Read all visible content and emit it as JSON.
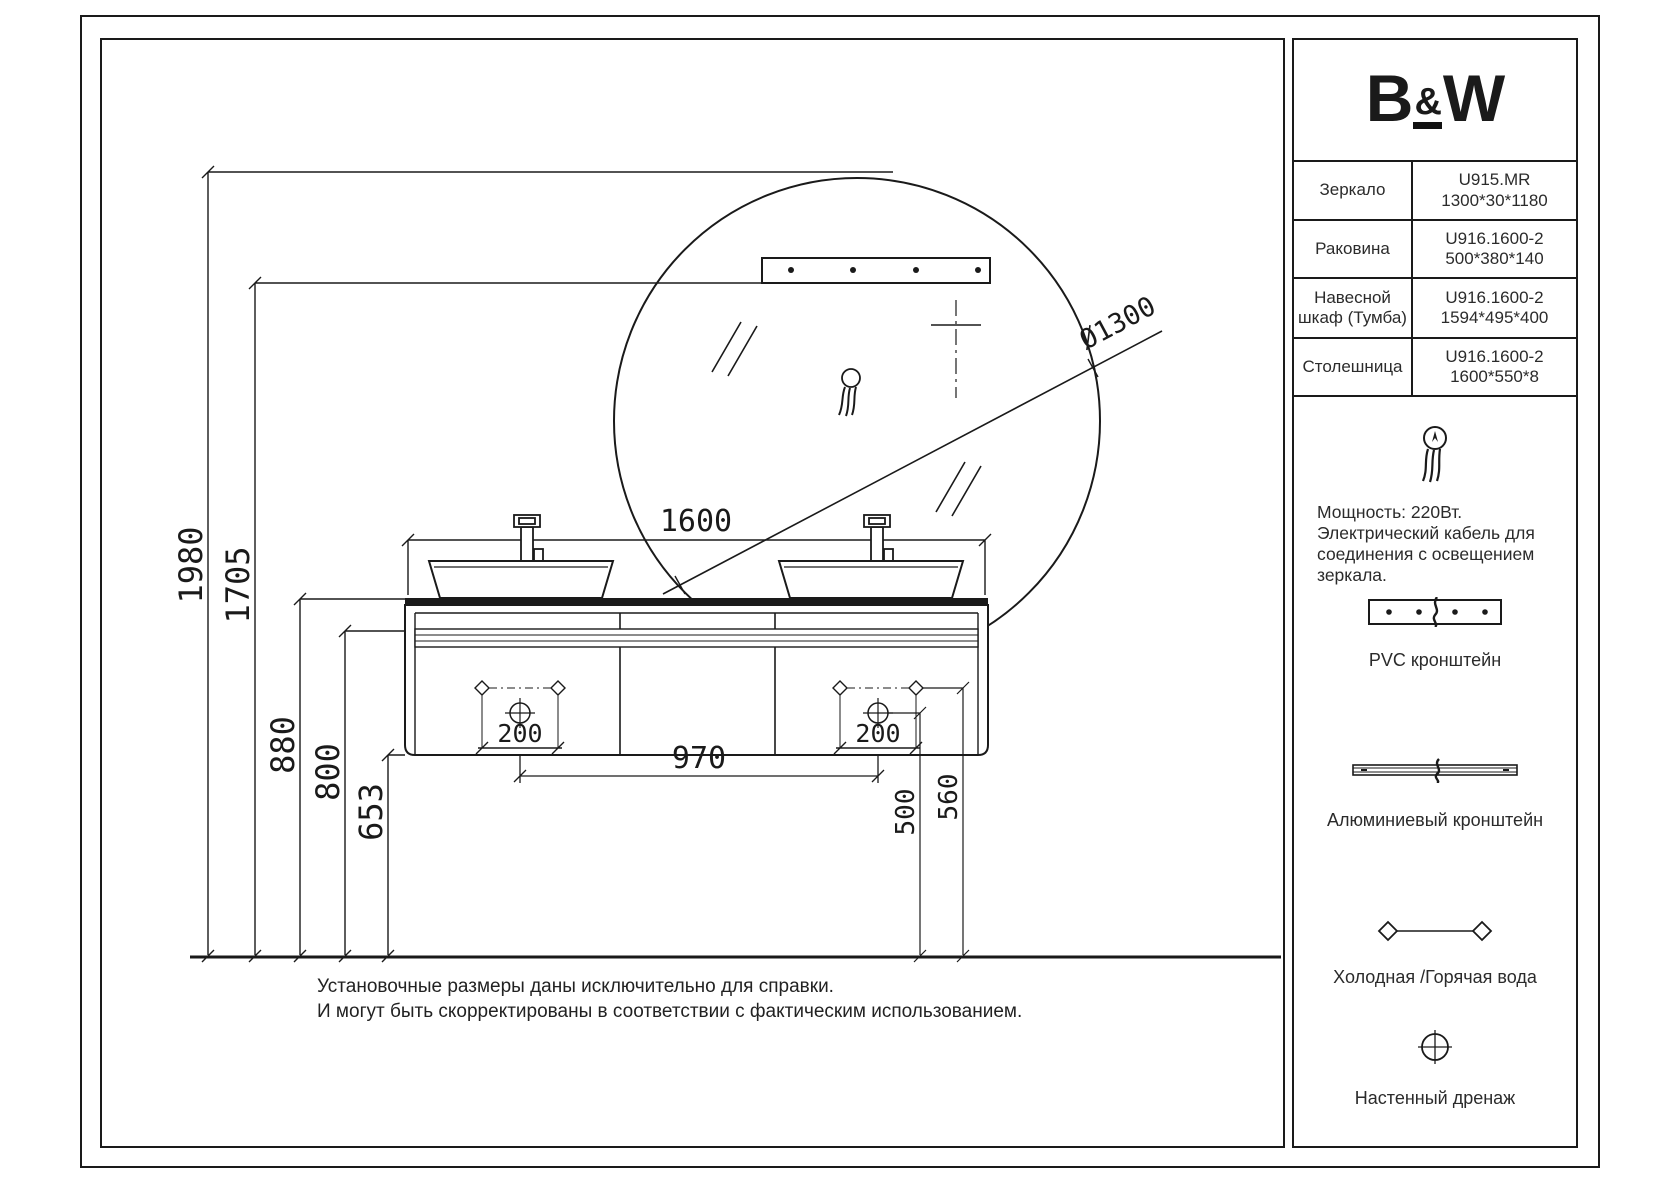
{
  "brand": {
    "logo_parts": [
      "B",
      "&",
      "W"
    ]
  },
  "spec_table": {
    "rows": [
      {
        "name": "Зеркало",
        "code": "U915.MR",
        "size": "1300*30*1180"
      },
      {
        "name": "Раковина",
        "code": "U916.1600-2",
        "size": "500*380*140"
      },
      {
        "name": "Навесной шкаф (Тумба)",
        "code": "U916.1600-2",
        "size": "1594*495*400"
      },
      {
        "name": "Столешница",
        "code": "U916.1600-2",
        "size": "1600*550*8"
      }
    ]
  },
  "legend": {
    "power_note_lines": [
      "Мощность: 220Вт.",
      "Электрический кабель для",
      "соединения с освещением",
      "зеркала."
    ],
    "pvc_label": "PVC кронштейн",
    "alu_label": "Алюминиевый кронштейн",
    "water_label": "Холодная /Горячая вода",
    "drain_label": "Настенный дренаж"
  },
  "dimensions": {
    "total_height": "1980",
    "mirror_mount_height": "1705",
    "countertop_height": "880",
    "rail_height": "800",
    "cabinet_bottom_height": "653",
    "cabinet_width": "1600",
    "drain_spacing": "970",
    "left_drain_offset": "200",
    "right_drain_offset": "200",
    "drain_height": "500",
    "supply_height": "560",
    "mirror_diameter": "Ø1300"
  },
  "footnote_lines": [
    "Установочные размеры даны исключительно для справки.",
    "И могут быть скорректированы в соответствии с фактическим использованием."
  ],
  "colors": {
    "ink": "#1a1a1a",
    "paper": "#ffffff"
  }
}
